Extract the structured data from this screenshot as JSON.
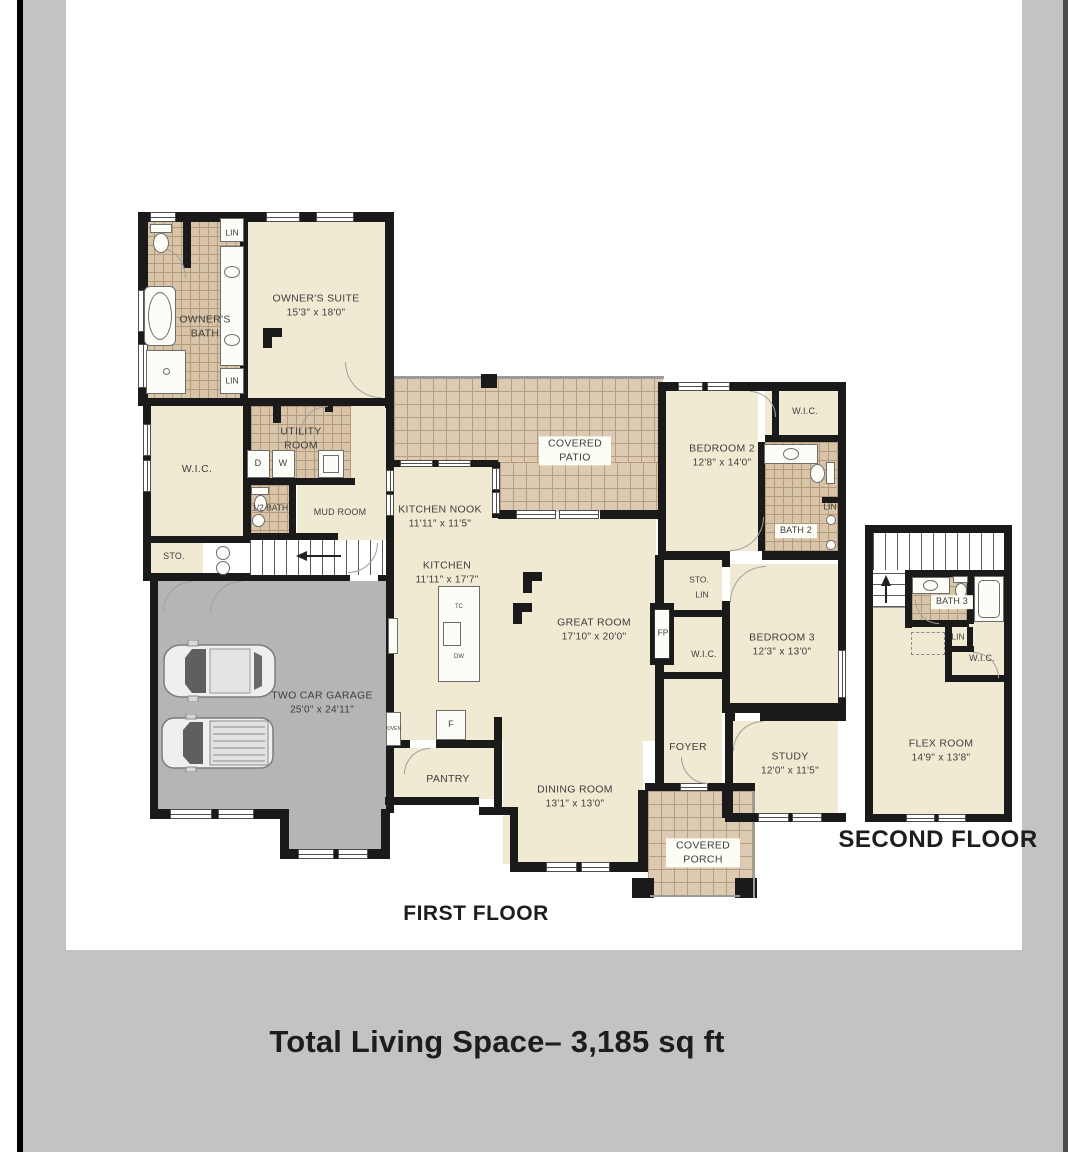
{
  "page": {
    "first_floor_label": "FIRST FLOOR",
    "second_floor_label": "SECOND FLOOR",
    "total_living_space": "Total Living Space– 3,185 sq ft"
  },
  "colors": {
    "room_fill": "#f0ead3",
    "tile_fill": "#dccbb2",
    "garage_fill": "#b5b5b5",
    "wall": "#1a1a1a",
    "outer_band": "#c3c3c3"
  },
  "first_floor": {
    "owners_suite": {
      "name": "OWNER'S SUITE",
      "dims": "15'3\" x 18'0\""
    },
    "owners_bath": {
      "name": "OWNER'S BATH"
    },
    "lin_owner_top": "LIN",
    "lin_owner_bottom": "LIN",
    "wic_owner": "W.I.C.",
    "utility": {
      "name": "UTILITY ROOM"
    },
    "dryer": "D",
    "washer": "W",
    "half_bath": "1/2 BATH",
    "mud_room": "MUD ROOM",
    "storage": "STO.",
    "kitchen_nook": {
      "name": "KITCHEN NOOK",
      "dims": "11'11\" x 11'5\""
    },
    "kitchen": {
      "name": "KITCHEN",
      "dims": "11'11\" x 17'7\""
    },
    "covered_patio": {
      "name": "COVERED PATIO"
    },
    "bedroom2": {
      "name": "BEDROOM 2",
      "dims": "12'8\" x 14'0\""
    },
    "wic_bed2": "W.I.C.",
    "bath2": "BATH 2",
    "lin_bath2": "LIN",
    "great_room": {
      "name": "GREAT ROOM",
      "dims": "17'10\" x 20'0\""
    },
    "sto_hall": "STO.",
    "lin_hall": "LIN",
    "fireplace": "FP",
    "wic_bed3": "W.I.C.",
    "bedroom3": {
      "name": "BEDROOM 3",
      "dims": "12'3\" x 13'0\""
    },
    "garage": {
      "name": "TWO CAR GARAGE",
      "dims": "25'0\" x 24'11\""
    },
    "oven": "OVEN",
    "fridge": "F",
    "tc": "TC",
    "dw": "DW",
    "pantry": "PANTRY",
    "dining": {
      "name": "DINING ROOM",
      "dims": "13'1\" x 13'0\""
    },
    "foyer": "FOYER",
    "study": {
      "name": "STUDY",
      "dims": "12'0\" x 11'5\""
    },
    "covered_porch": {
      "name": "COVERED PORCH"
    }
  },
  "second_floor": {
    "bath3": "BATH 3",
    "lin": "LIN",
    "wic": "W.I.C.",
    "flex": {
      "name": "FLEX ROOM",
      "dims": "14'9\" x 13'8\""
    }
  }
}
